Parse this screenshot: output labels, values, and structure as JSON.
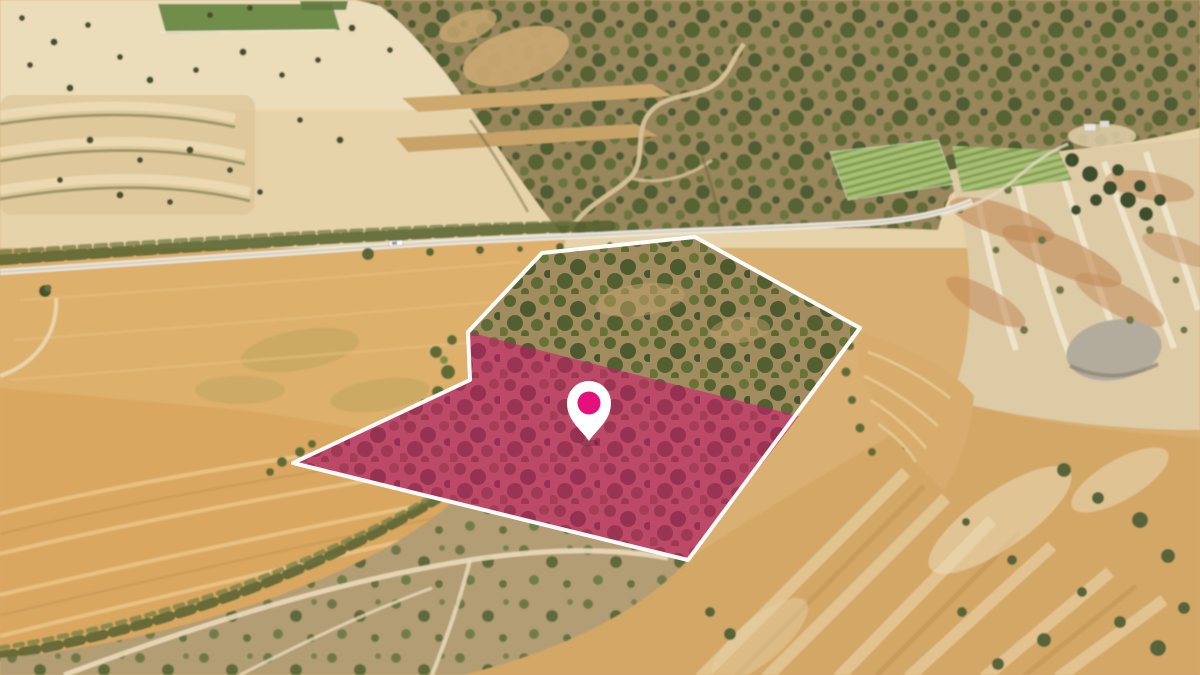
{
  "annotation": {
    "parcel_outline": {
      "color": "#ffffff",
      "stroke_width": "4",
      "points": "293,463 470,380 468,332 542,253 695,237 860,328 688,560"
    },
    "parcel_highlight": {
      "color": "#d31270",
      "opacity": "0.55",
      "points": "468,332 799,416 688,560 293,463 470,380"
    },
    "marker": {
      "icon": "location-pin",
      "pin_color": "#ffffff",
      "dot_color": "#e6107d",
      "x": "589",
      "y": "403"
    }
  },
  "palette": {
    "golden_field": "#d9a75f",
    "pale_distant_field": "#e6d3a9",
    "green_crop_field": "#6f8d48",
    "scrub_olive": "#5d6836",
    "badlands_pale": "#ddcba6",
    "road": "#edeadf"
  }
}
